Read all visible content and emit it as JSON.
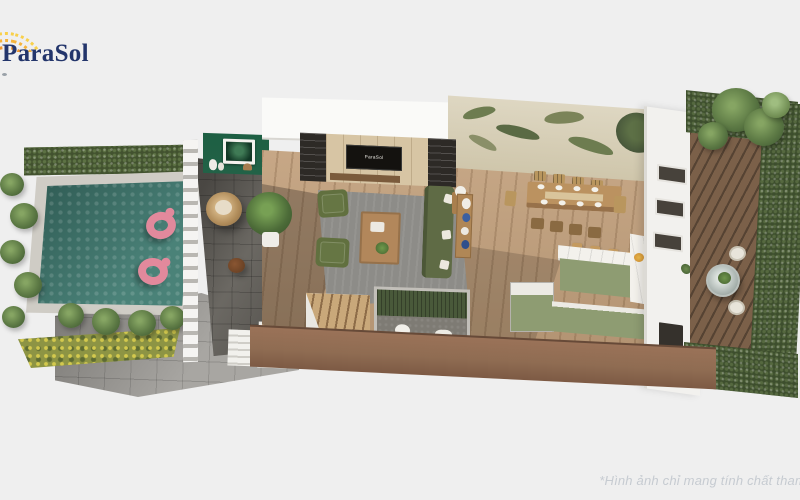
{
  "logo": {
    "text": "ParaSol"
  },
  "tv": {
    "screen_text": "ParaSol"
  },
  "watermark": {
    "text": "*Hình ảnh chỉ mang tính chất tham"
  },
  "palette": {
    "bg": "#efefef",
    "logoNavy": "#23356b",
    "watermarkGray": "#c6cbd1",
    "hedgeDark": "#42522f",
    "palmGreen": "#567441",
    "flowerYellow": "#8d9444",
    "poolStone": "#cfccc5",
    "poolWater": "#3f7a70",
    "flamingoPink": "#e2899c",
    "paveGray": "#a8a6a2",
    "patioGray": "#75726c",
    "woodFloor": "#c2a07c",
    "wallWhite": "#f2f1ee",
    "accentGreenWall": "#226247",
    "muralBeige": "#d8d1bb",
    "muralLeaf": "#6d7c50",
    "sofaOlive": "#5f6b45",
    "rugGray": "#8d8c88",
    "tableWood": "#bb9260",
    "tvBlack": "#14120f",
    "shelfDark": "#2d2a26",
    "islandSage": "#8e9c72",
    "marbleWhite": "#f3f1ec",
    "bathGreen": "#49593a",
    "bathFloorGray": "#7e7b74",
    "brownCut": "#8f6c52",
    "deckBrown": "#7b6049",
    "courtHedge": "#3d4e2d",
    "stairWood": "#c9a87a"
  }
}
